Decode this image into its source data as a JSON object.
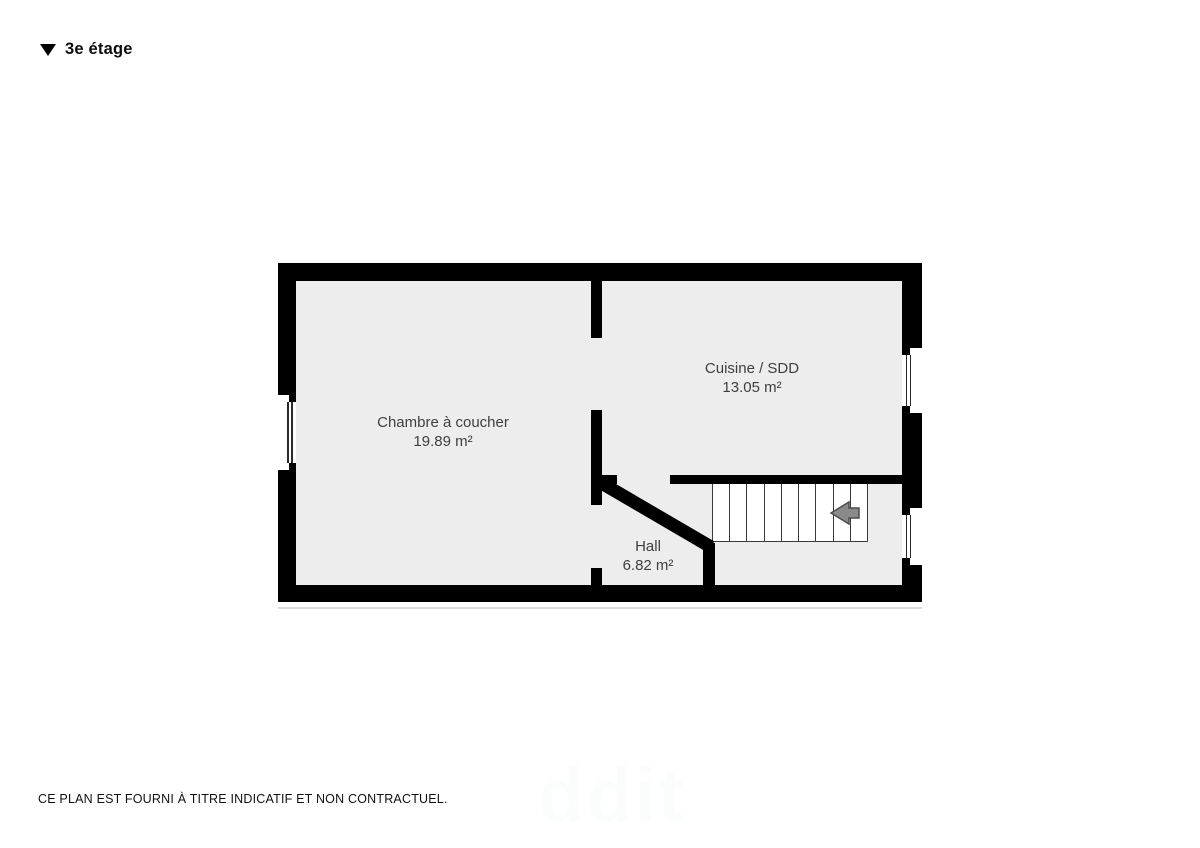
{
  "header": {
    "title": "3e étage",
    "marker_icon": "triangle-down"
  },
  "rooms": [
    {
      "name": "Chambre à coucher",
      "area": "19.89 m²"
    },
    {
      "name": "Cuisine / SDD",
      "area": "13.05 m²"
    },
    {
      "name": "Hall",
      "area": "6.82 m²"
    }
  ],
  "stairs": {
    "steps": 9,
    "direction_icon": "arrow-left"
  },
  "windows": {
    "left_wall": 1,
    "right_wall": 2
  },
  "footer": {
    "disclaimer": "CE PLAN EST FOURNI À TITRE INDICATIF ET NON CONTRACTUEL."
  },
  "watermark": "ddit",
  "colors": {
    "wall": "#000000",
    "floor": "#ededee",
    "labeltext": "#3f3f3f",
    "arrowfill": "#8a8a8a",
    "arrowstroke": "#4d4d4d",
    "stairline": "#3a3a3a"
  }
}
